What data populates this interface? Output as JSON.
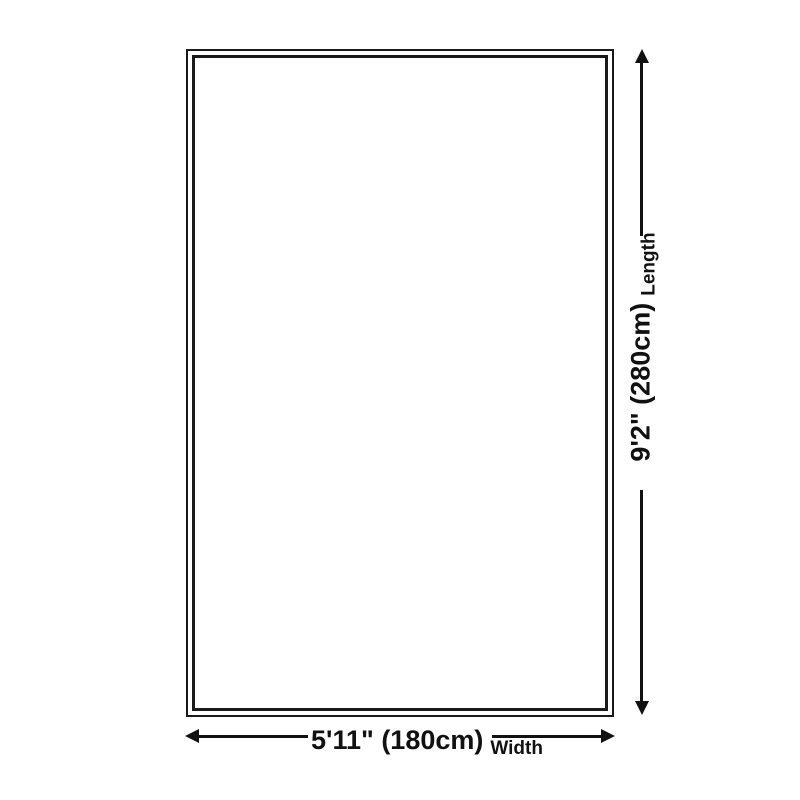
{
  "diagram": {
    "title": "rug-size-diagram",
    "colors": {
      "background": "#ffffff",
      "line": "#111111",
      "rug_border": "#1a1a1a"
    },
    "length": {
      "value": "9'2\" (280cm)",
      "label": "Length"
    },
    "width": {
      "value": "5'11\" (180cm)",
      "label": "Width"
    }
  }
}
